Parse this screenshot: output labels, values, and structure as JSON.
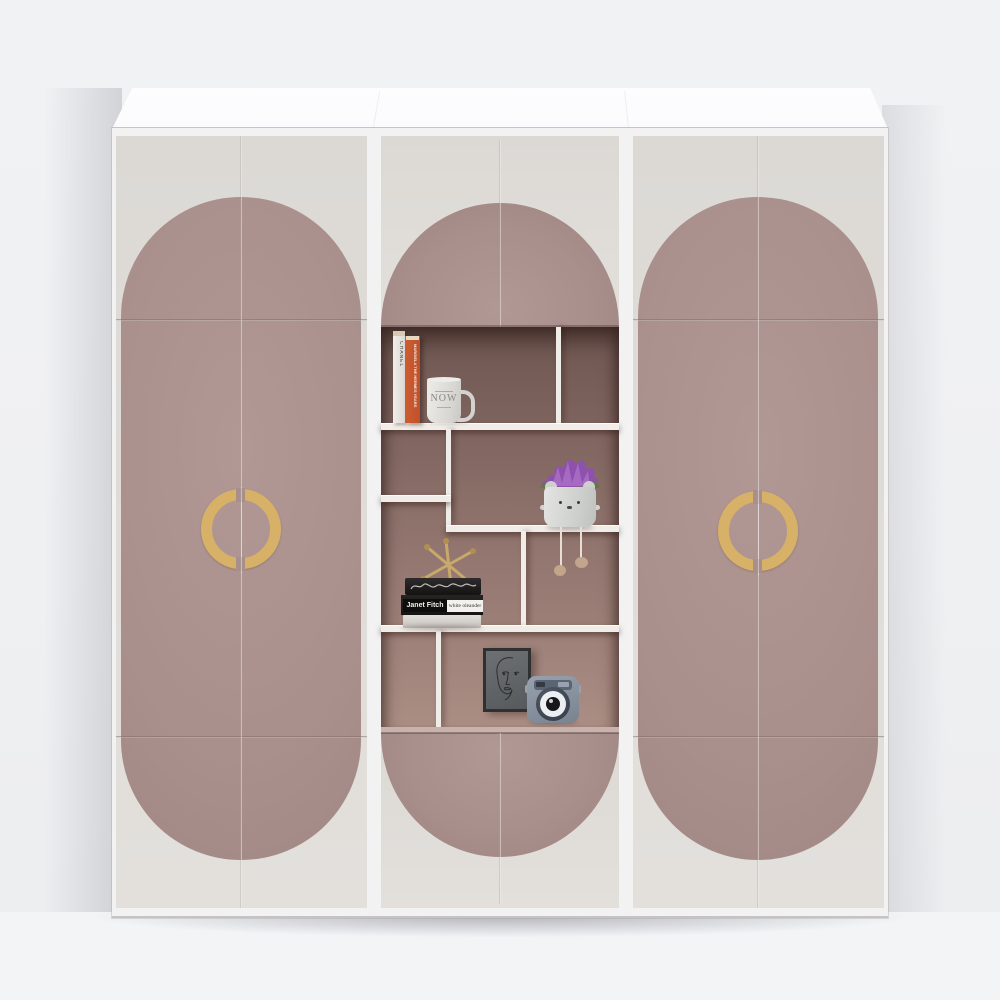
{
  "scene": {
    "label": "Three-section wardrobe render, cream doors with arched rose panels, center open display shelving, split gold ring handles"
  },
  "texts": {
    "mug": "NOW",
    "book_spine_white": "CHANEL",
    "book_spine_orange": "MARGIELA THE HERMES YEARS",
    "stack_author": "Janet Fitch",
    "stack_title": "white oleander"
  },
  "objects": {
    "left_handle": "split gold ring handle",
    "right_handle": "split gold ring handle",
    "shelf_items": [
      "white CHANEL book",
      "orange Margiela book",
      "white NOW mug",
      "bear-face planter with purple bloom and dangling legs",
      "gold jack ornament on book stack",
      "Janet Fitch white oleander book stack",
      "line-art portrait frame",
      "blue-grey instant camera"
    ]
  },
  "colors": {
    "wall": "#eff0f2",
    "floor": "#f3f4f6",
    "slab": "#fbfbfd",
    "carcass": "#f2f2f3",
    "door": "#dcd9d5",
    "door-light": "#e3e0dc",
    "mauve": "#a98f8b",
    "mauve-light": "#b29894",
    "mauve-dark": "#9c827e",
    "gold": "#d7b167",
    "interior-top": "#6e5651",
    "interior-mid": "#8c706a",
    "interior-bottom": "#ab8e84",
    "shelf": "#f0ede9",
    "opening-floor": "#c8b2ad",
    "book-white": "#e9e7e3",
    "book-orange": "#c0512a",
    "pages": "#d7cab3",
    "mug": "#e0dfdc",
    "text-gray": "#8b8780",
    "pot": "#d8d9d7",
    "flower": "#8e52ac",
    "leaf": "#5e7c40",
    "paw": "#c2a58a",
    "label-white": "#f3f1ed",
    "frame-border": "#2e3031",
    "camera-dark": "#5b6472",
    "lens-white": "#eceff1"
  }
}
